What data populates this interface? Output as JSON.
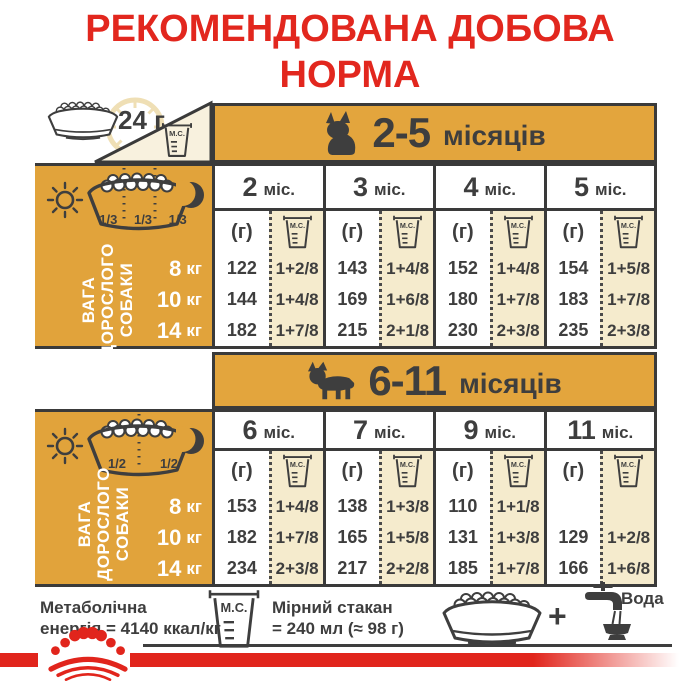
{
  "colors": {
    "gold": "#E2A43C",
    "cream": "#F5EBCD",
    "dark": "#3E3E3E",
    "red": "#E1251C",
    "pale": "#F8F1DE"
  },
  "title": {
    "line1": "РЕКОМЕНДОВАНА ДОБОВА",
    "line2": "НОРМА"
  },
  "top": {
    "amount": "24 г"
  },
  "labels": {
    "mc": "М.С.",
    "grams": "(г)"
  },
  "side_label": [
    "ВАГА",
    "ДОРОСЛОГО",
    "СОБАКИ"
  ],
  "tables": [
    {
      "range": "2-5",
      "range_unit": "місяців",
      "portions": [
        "1/3",
        "1/3",
        "1/3"
      ],
      "columns": [
        {
          "num": "2",
          "unit": "міс."
        },
        {
          "num": "3",
          "unit": "міс."
        },
        {
          "num": "4",
          "unit": "міс."
        },
        {
          "num": "5",
          "unit": "міс."
        }
      ],
      "rows": [
        {
          "weight": "8",
          "unit": "кг",
          "cells": [
            {
              "g": "122",
              "mc": "1+2/8"
            },
            {
              "g": "143",
              "mc": "1+4/8"
            },
            {
              "g": "152",
              "mc": "1+4/8"
            },
            {
              "g": "154",
              "mc": "1+5/8"
            }
          ]
        },
        {
          "weight": "10",
          "unit": "кг",
          "cells": [
            {
              "g": "144",
              "mc": "1+4/8"
            },
            {
              "g": "169",
              "mc": "1+6/8"
            },
            {
              "g": "180",
              "mc": "1+7/8"
            },
            {
              "g": "183",
              "mc": "1+7/8"
            }
          ]
        },
        {
          "weight": "14",
          "unit": "кг",
          "cells": [
            {
              "g": "182",
              "mc": "1+7/8"
            },
            {
              "g": "215",
              "mc": "2+1/8"
            },
            {
              "g": "230",
              "mc": "2+3/8"
            },
            {
              "g": "235",
              "mc": "2+3/8"
            }
          ]
        }
      ]
    },
    {
      "range": "6-11",
      "range_unit": "місяців",
      "portions": [
        "1/2",
        "1/2"
      ],
      "columns": [
        {
          "num": "6",
          "unit": "міс."
        },
        {
          "num": "7",
          "unit": "міс."
        },
        {
          "num": "9",
          "unit": "міс."
        },
        {
          "num": "11",
          "unit": "міс."
        }
      ],
      "rows": [
        {
          "weight": "8",
          "unit": "кг",
          "cells": [
            {
              "g": "153",
              "mc": "1+4/8"
            },
            {
              "g": "138",
              "mc": "1+3/8"
            },
            {
              "g": "110",
              "mc": "1+1/8"
            },
            {
              "g": "",
              "mc": ""
            }
          ]
        },
        {
          "weight": "10",
          "unit": "кг",
          "cells": [
            {
              "g": "182",
              "mc": "1+7/8"
            },
            {
              "g": "165",
              "mc": "1+5/8"
            },
            {
              "g": "131",
              "mc": "1+3/8"
            },
            {
              "g": "129",
              "mc": "1+2/8"
            }
          ]
        },
        {
          "weight": "14",
          "unit": "кг",
          "cells": [
            {
              "g": "234",
              "mc": "2+3/8"
            },
            {
              "g": "217",
              "mc": "2+2/8"
            },
            {
              "g": "185",
              "mc": "1+7/8"
            },
            {
              "g": "166",
              "mc": "1+6/8"
            }
          ]
        }
      ]
    }
  ],
  "footer": {
    "energy1": "Метаболічна",
    "energy2": "енергія = 4140 ккал/кг",
    "cup1": "Мірний стакан",
    "cup2": "= 240 мл (≈ 98 г)",
    "plus": "+",
    "water": "Вода"
  }
}
